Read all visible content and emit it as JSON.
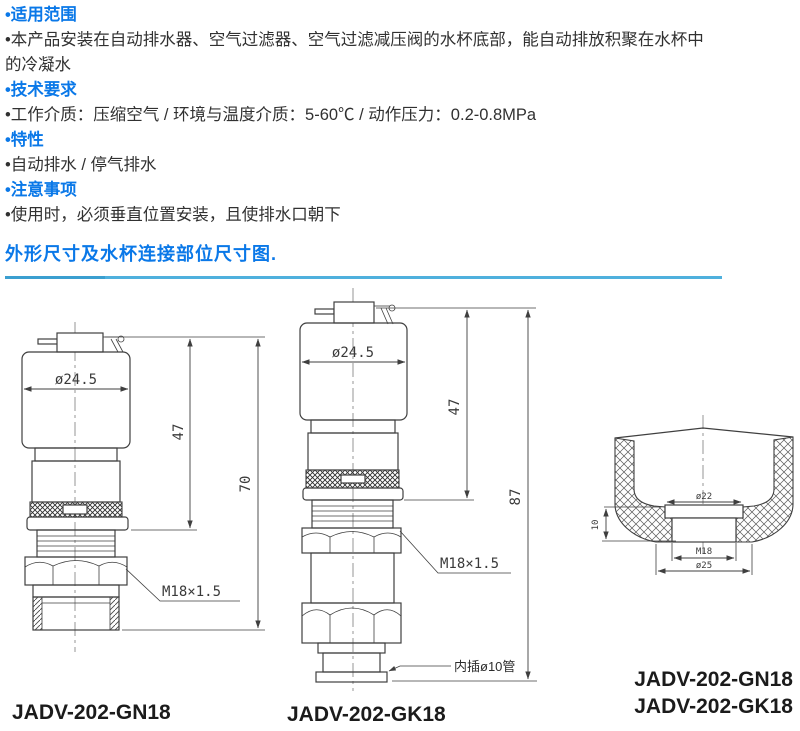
{
  "colors": {
    "heading_blue": "#0a78e8",
    "divider_main": "#4fb0dd",
    "divider_left": "#3b9fd0",
    "line": "#3f3f3f",
    "text": "#313131",
    "label": "#1b1b1b"
  },
  "notes": {
    "items": [
      {
        "style": "heading",
        "text": "•适用范围"
      },
      {
        "style": "body",
        "text": "•本产品安装在自动排水器、空气过滤器、空气过滤减压阀的水杯底部，能自动排放积聚在水杯中的冷凝水"
      },
      {
        "style": "heading",
        "text": "•技术要求"
      },
      {
        "style": "body",
        "text": "•工作介质：压缩空气 / 环境与温度介质：5-60℃ / 动作压力：0.2-0.8MPa"
      },
      {
        "style": "heading",
        "text": "•特性"
      },
      {
        "style": "body",
        "text": "•自动排水 / 停气排水"
      },
      {
        "style": "heading",
        "text": "•注意事项"
      },
      {
        "style": "body",
        "text": "•使用时，必须垂直位置安装，且使排水口朝下"
      }
    ]
  },
  "section": {
    "title": "外形尺寸及水杯连接部位尺寸图."
  },
  "drawings": {
    "gn18": {
      "dim_diameter": "ø24.5",
      "dim_height_47": "47",
      "dim_height_70": "70",
      "thread": "M18×1.5",
      "label": "JADV-202-GN18"
    },
    "gk18": {
      "dim_diameter": "ø24.5",
      "dim_height_47": "47",
      "dim_height_87": "87",
      "thread": "M18×1.5",
      "tube_note": "内插ø10管",
      "label": "JADV-202-GK18"
    },
    "cup": {
      "dim_top": "ø22",
      "dim_thread": "M18",
      "dim_bottom": "ø25",
      "dim_depth": "10",
      "label_line1": "JADV-202-GN18",
      "label_line2": "JADV-202-GK18"
    }
  }
}
